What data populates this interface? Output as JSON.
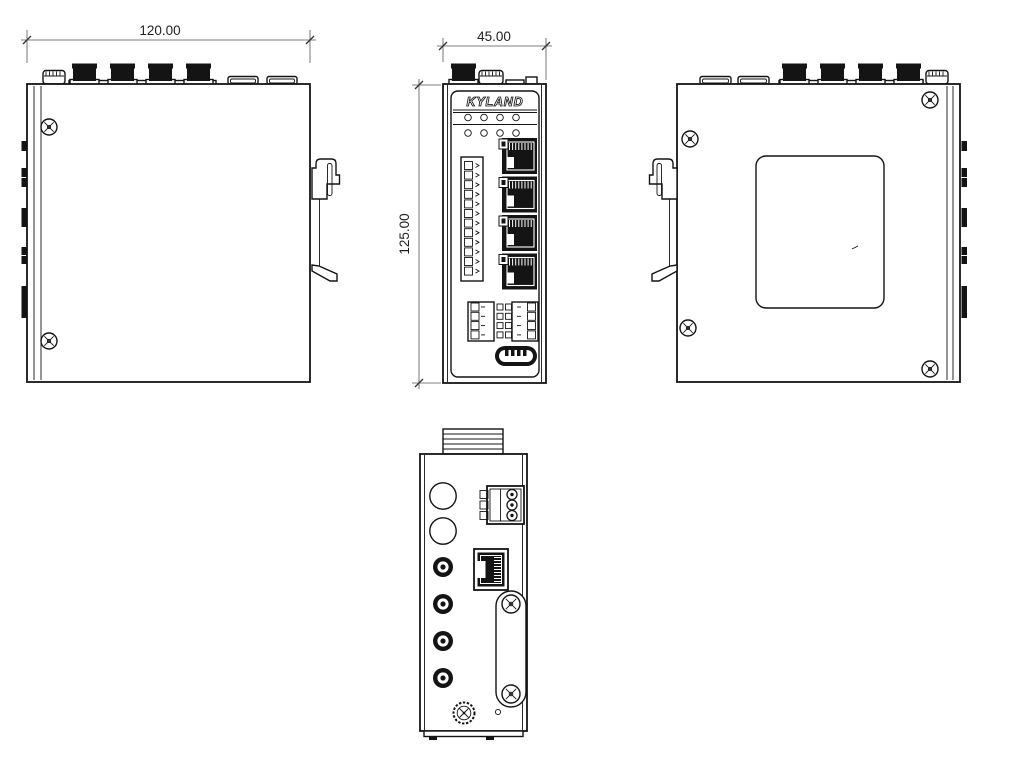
{
  "drawing": {
    "brand_logo": "KYLAND",
    "dimensions": {
      "width": "120.00",
      "depth": "45.00",
      "height": "125.00"
    },
    "front_panel": {
      "led_rows": 2,
      "leds_per_row": 4,
      "rj45_ports": 4,
      "terminal_pins": 12,
      "io_rows": 4
    },
    "bottom_panel": {
      "antenna_connectors": 4,
      "power_pins": 3
    }
  }
}
